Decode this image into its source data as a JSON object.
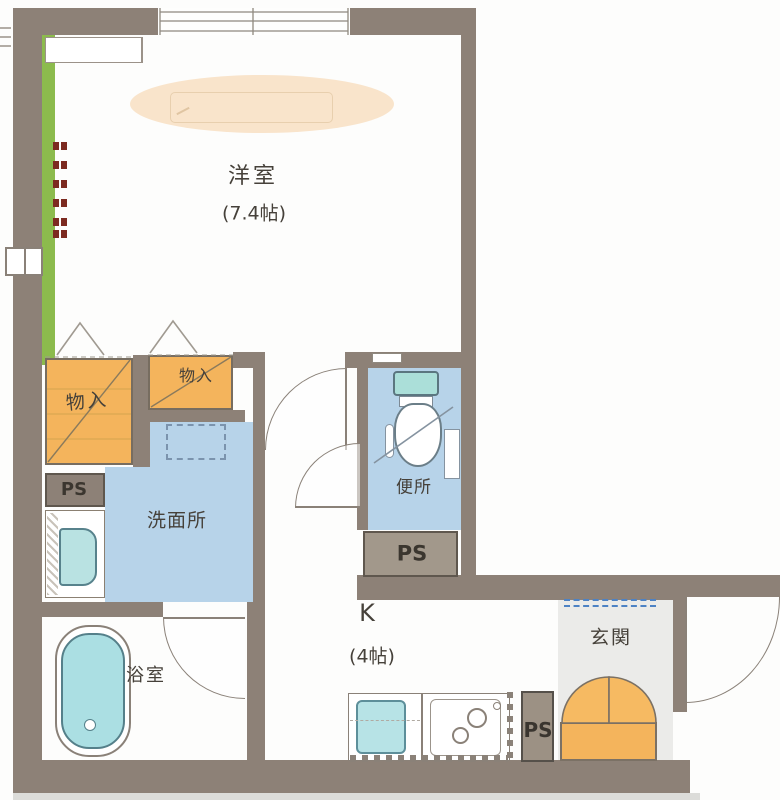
{
  "plan": {
    "title": "apartment-floor-plan",
    "rooms": {
      "western_room": {
        "label": "洋室",
        "size_label": "(7.4帖)"
      },
      "kitchen": {
        "label": "K",
        "size_label": "(4帖)"
      },
      "washroom": {
        "label": "洗面所"
      },
      "toilet": {
        "label": "便所"
      },
      "bathroom": {
        "label": "浴室"
      },
      "entrance": {
        "label": "玄関"
      },
      "storage1": {
        "label": "物入"
      },
      "storage2": {
        "label": "物入"
      },
      "pipe_space1": {
        "label": "PS"
      },
      "pipe_space2": {
        "label": "PS"
      },
      "pipe_space3": {
        "label": "PS"
      }
    },
    "colors": {
      "wall": "#8d8177",
      "storage_orange": "#f4b45c",
      "water_blue": "#b7d3e9",
      "fixture_teal": "#abdfe3",
      "balcony_green": "#8cbb4d",
      "ceiling_light_peach": "#f9e4cb",
      "entrance_floor": "#ebebe9",
      "step_dash_blue": "#4d82c4",
      "shutter_dash_red": "#7c2a20"
    }
  }
}
